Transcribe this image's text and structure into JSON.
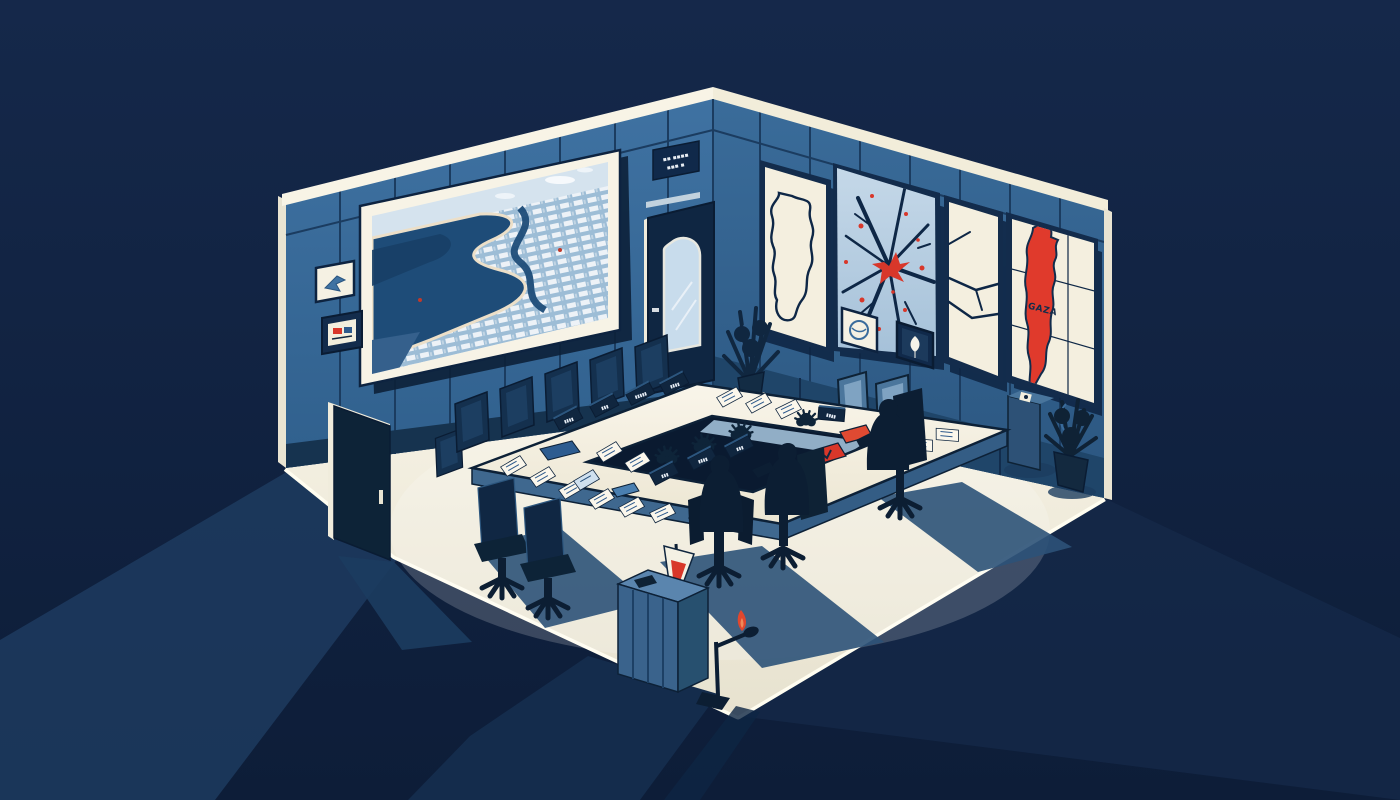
{
  "alt": "Isometric illustration of a dark navy situation room: large aerial coastline screen and two small framed pictures on the left wall, four wall maps on the right wall including a cracked map with red impact marks and a map with a red GAZA strip, a white rectangular ring conference table with name plates, papers, red and blue folders and small plants, three dark silhouetted figures in office chairs, empty chairs, a corner door with arched window, a front-left door, potted plants, a floor speaker, and a podium with a small red-and-white flag and microphone casting long shadows on the cream floor.",
  "palette": {
    "background": "#122440",
    "wall_blue": "#3b6d9c",
    "wall_panel_line": "#1b3c60",
    "baseboard": "#16334f",
    "trim_cream": "#f8f4e6",
    "floor_cream": "#f2eedf",
    "floor_shadow": "#2c5278",
    "outside_shadow": "#1d3b5f",
    "table_top": "#f7f3e6",
    "silhouette_navy": "#0c1e33",
    "accent_red": "#d8372a",
    "map_cream": "#f4efdf",
    "map_light_blue": "#b5cde1",
    "screen_water": "#1e4c78",
    "screen_sky": "#d5e3ee"
  },
  "left_wall": {
    "sign_line_1": "▪▪ ▪▪▪▪",
    "sign_line_2": "▪▪▪ ▪"
  },
  "right_wall": {
    "map4_label": "GAZA"
  },
  "table": {
    "name_plates": [
      "▮▮▮▮",
      "▮▮▮",
      "▮▮▮▮▮",
      "▮▮▮▮",
      "▮▮▮",
      "▮▮▮▮",
      "▮▮▮",
      "▮▮▮▮"
    ]
  }
}
